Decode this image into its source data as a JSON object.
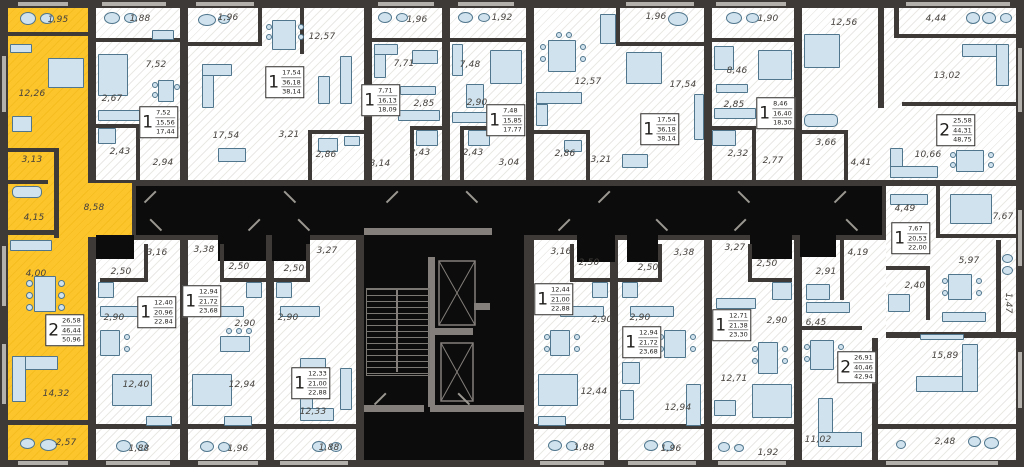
{
  "plan_type": "residential-floor-plan",
  "palette": {
    "wall": "#3e3a37",
    "floor": "#ffffff",
    "hatch": "#ebe9e6",
    "highlight": "#fcc52c",
    "core": "#0c0c0c",
    "core_line": "#847f7b",
    "furniture": "#cfe2ed",
    "furniture_border": "#50768d",
    "label_color": "#45413d"
  },
  "apartments": [
    {
      "name": "apartment-2room-highlighted",
      "highlighted": true,
      "info": {
        "rooms": "2",
        "areas": [
          "26,58",
          "46,44",
          "50,96"
        ],
        "x": 65,
        "y": 330
      },
      "labels": [
        {
          "t": "1,95",
          "x": 58,
          "y": 20
        },
        {
          "t": "12,26",
          "x": 32,
          "y": 94
        },
        {
          "t": "3,13",
          "x": 32,
          "y": 160
        },
        {
          "t": "4,15",
          "x": 34,
          "y": 218
        },
        {
          "t": "8,58",
          "x": 94,
          "y": 208
        },
        {
          "t": "4,00",
          "x": 36,
          "y": 274
        },
        {
          "t": "14,32",
          "x": 56,
          "y": 394
        },
        {
          "t": "2,57",
          "x": 66,
          "y": 443
        }
      ]
    },
    {
      "name": "apartment-1room-a",
      "info": {
        "rooms": "1",
        "areas": [
          "7,52",
          "15,56",
          "17,44"
        ],
        "x": 159,
        "y": 122
      },
      "labels": [
        {
          "t": "1,88",
          "x": 140,
          "y": 19
        },
        {
          "t": "7,52",
          "x": 156,
          "y": 65
        },
        {
          "t": "2,67",
          "x": 112,
          "y": 99
        },
        {
          "t": "2,43",
          "x": 120,
          "y": 152
        },
        {
          "t": "2,94",
          "x": 163,
          "y": 163
        }
      ]
    },
    {
      "name": "apartment-1room-b",
      "info": {
        "rooms": "1",
        "areas": [
          "17,54",
          "36,18",
          "38,14"
        ],
        "x": 285,
        "y": 82
      },
      "labels": [
        {
          "t": "1,96",
          "x": 228,
          "y": 18
        },
        {
          "t": "17,54",
          "x": 226,
          "y": 136
        },
        {
          "t": "12,57",
          "x": 322,
          "y": 37
        },
        {
          "t": "3,21",
          "x": 289,
          "y": 135
        },
        {
          "t": "2,86",
          "x": 326,
          "y": 155
        }
      ]
    },
    {
      "name": "apartment-1room-c",
      "info": {
        "rooms": "1",
        "areas": [
          "7,71",
          "16,13",
          "18,09"
        ],
        "x": 381,
        "y": 100
      },
      "labels": [
        {
          "t": "1,96",
          "x": 417,
          "y": 20
        },
        {
          "t": "7,71",
          "x": 404,
          "y": 64
        },
        {
          "t": "2,85",
          "x": 424,
          "y": 104
        },
        {
          "t": "2,43",
          "x": 420,
          "y": 153
        },
        {
          "t": "3,14",
          "x": 380,
          "y": 164
        }
      ]
    },
    {
      "name": "apartment-1room-d",
      "info": {
        "rooms": "1",
        "areas": [
          "7,48",
          "15,85",
          "17,77"
        ],
        "x": 506,
        "y": 120
      },
      "labels": [
        {
          "t": "1,92",
          "x": 502,
          "y": 18
        },
        {
          "t": "7,48",
          "x": 470,
          "y": 65
        },
        {
          "t": "2,90",
          "x": 477,
          "y": 103
        },
        {
          "t": "2,43",
          "x": 473,
          "y": 153
        },
        {
          "t": "3,04",
          "x": 509,
          "y": 163
        }
      ]
    },
    {
      "name": "apartment-1room-e",
      "info": {
        "rooms": "1",
        "areas": [
          "17,54",
          "36,18",
          "38,14"
        ],
        "x": 660,
        "y": 129
      },
      "labels": [
        {
          "t": "12,57",
          "x": 588,
          "y": 82
        },
        {
          "t": "1,96",
          "x": 656,
          "y": 17
        },
        {
          "t": "17,54",
          "x": 683,
          "y": 85
        },
        {
          "t": "2,86",
          "x": 565,
          "y": 154
        },
        {
          "t": "3,21",
          "x": 601,
          "y": 160
        }
      ]
    },
    {
      "name": "apartment-1room-f",
      "info": {
        "rooms": "1",
        "areas": [
          "8,46",
          "16,40",
          "18,30"
        ],
        "x": 776,
        "y": 113
      },
      "labels": [
        {
          "t": "1,90",
          "x": 768,
          "y": 19
        },
        {
          "t": "8,46",
          "x": 737,
          "y": 71
        },
        {
          "t": "2,85",
          "x": 734,
          "y": 105
        },
        {
          "t": "2,32",
          "x": 738,
          "y": 154
        },
        {
          "t": "2,77",
          "x": 773,
          "y": 161
        }
      ]
    },
    {
      "name": "apartment-2room-a",
      "info": {
        "rooms": "2",
        "areas": [
          "25,58",
          "44,31",
          "48,75"
        ],
        "x": 956,
        "y": 130
      },
      "labels": [
        {
          "t": "12,56",
          "x": 844,
          "y": 23
        },
        {
          "t": "4,44",
          "x": 936,
          "y": 19
        },
        {
          "t": "13,02",
          "x": 947,
          "y": 76
        },
        {
          "t": "3,66",
          "x": 826,
          "y": 143
        },
        {
          "t": "4,41",
          "x": 861,
          "y": 163
        },
        {
          "t": "10,66",
          "x": 928,
          "y": 155
        }
      ]
    },
    {
      "name": "apartment-1room-g",
      "info": {
        "rooms": "1",
        "areas": [
          "7,67",
          "20,53",
          "22,00"
        ],
        "x": 911,
        "y": 238
      },
      "labels": [
        {
          "t": "4,49",
          "x": 905,
          "y": 209
        },
        {
          "t": "7,67",
          "x": 1003,
          "y": 217
        },
        {
          "t": "5,97",
          "x": 969,
          "y": 261
        },
        {
          "t": "2,40",
          "x": 915,
          "y": 286
        },
        {
          "t": "1,47",
          "x": 1008,
          "y": 303,
          "rot": 90
        }
      ]
    },
    {
      "name": "apartment-2room-b",
      "info": {
        "rooms": "2",
        "areas": [
          "26,91",
          "40,46",
          "42,94"
        ],
        "x": 857,
        "y": 367
      },
      "labels": [
        {
          "t": "4,19",
          "x": 858,
          "y": 253
        },
        {
          "t": "2,91",
          "x": 826,
          "y": 272
        },
        {
          "t": "6,45",
          "x": 816,
          "y": 323
        },
        {
          "t": "11,02",
          "x": 818,
          "y": 440
        },
        {
          "t": "15,89",
          "x": 945,
          "y": 356
        },
        {
          "t": "2,48",
          "x": 945,
          "y": 442
        }
      ]
    },
    {
      "name": "apartment-1room-h",
      "info": {
        "rooms": "1",
        "areas": [
          "12,71",
          "21,38",
          "23,30"
        ],
        "x": 732,
        "y": 325
      },
      "labels": [
        {
          "t": "3,27",
          "x": 735,
          "y": 248
        },
        {
          "t": "2,50",
          "x": 767,
          "y": 264
        },
        {
          "t": "2,90",
          "x": 777,
          "y": 321
        },
        {
          "t": "12,71",
          "x": 734,
          "y": 379
        },
        {
          "t": "1,92",
          "x": 768,
          "y": 453
        }
      ]
    },
    {
      "name": "apartment-1room-i",
      "info": {
        "rooms": "1",
        "areas": [
          "12,44",
          "21,00",
          "22,88"
        ],
        "x": 554,
        "y": 299
      },
      "labels": [
        {
          "t": "3,16",
          "x": 561,
          "y": 252
        },
        {
          "t": "2,50",
          "x": 589,
          "y": 263
        },
        {
          "t": "2,90",
          "x": 602,
          "y": 320
        },
        {
          "t": "12,44",
          "x": 594,
          "y": 392
        },
        {
          "t": "1,88",
          "x": 584,
          "y": 448
        }
      ]
    },
    {
      "name": "apartment-1room-j",
      "info": {
        "rooms": "1",
        "areas": [
          "12,94",
          "21,72",
          "23,68"
        ],
        "x": 642,
        "y": 342
      },
      "labels": [
        {
          "t": "3,38",
          "x": 684,
          "y": 253
        },
        {
          "t": "2,50",
          "x": 648,
          "y": 268
        },
        {
          "t": "2,90",
          "x": 640,
          "y": 318
        },
        {
          "t": "12,94",
          "x": 678,
          "y": 408
        },
        {
          "t": "1,96",
          "x": 671,
          "y": 449
        }
      ]
    },
    {
      "name": "apartment-1room-k",
      "info": {
        "rooms": "1",
        "areas": [
          "12,94",
          "21,72",
          "23,68"
        ],
        "x": 202,
        "y": 301
      },
      "labels": [
        {
          "t": "3,38",
          "x": 204,
          "y": 250
        },
        {
          "t": "2,50",
          "x": 239,
          "y": 267
        },
        {
          "t": "2,90",
          "x": 245,
          "y": 324
        },
        {
          "t": "12,94",
          "x": 242,
          "y": 385
        },
        {
          "t": "1,96",
          "x": 238,
          "y": 449
        }
      ]
    },
    {
      "name": "apartment-1room-l",
      "info": {
        "rooms": "1",
        "areas": [
          "12,33",
          "21,00",
          "22,88"
        ],
        "x": 311,
        "y": 383
      },
      "labels": [
        {
          "t": "3,27",
          "x": 327,
          "y": 251
        },
        {
          "t": "2,50",
          "x": 294,
          "y": 269
        },
        {
          "t": "2,90",
          "x": 288,
          "y": 318
        },
        {
          "t": "12,33",
          "x": 313,
          "y": 412
        },
        {
          "t": "1,88",
          "x": 329,
          "y": 448
        }
      ]
    },
    {
      "name": "apartment-1room-m",
      "info": {
        "rooms": "1",
        "areas": [
          "12,40",
          "20,96",
          "22,84"
        ],
        "x": 157,
        "y": 312
      },
      "labels": [
        {
          "t": "3,16",
          "x": 157,
          "y": 253
        },
        {
          "t": "2,50",
          "x": 121,
          "y": 272
        },
        {
          "t": "2,90",
          "x": 114,
          "y": 318
        },
        {
          "t": "12,40",
          "x": 136,
          "y": 385
        },
        {
          "t": "1,88",
          "x": 139,
          "y": 449
        }
      ]
    }
  ]
}
